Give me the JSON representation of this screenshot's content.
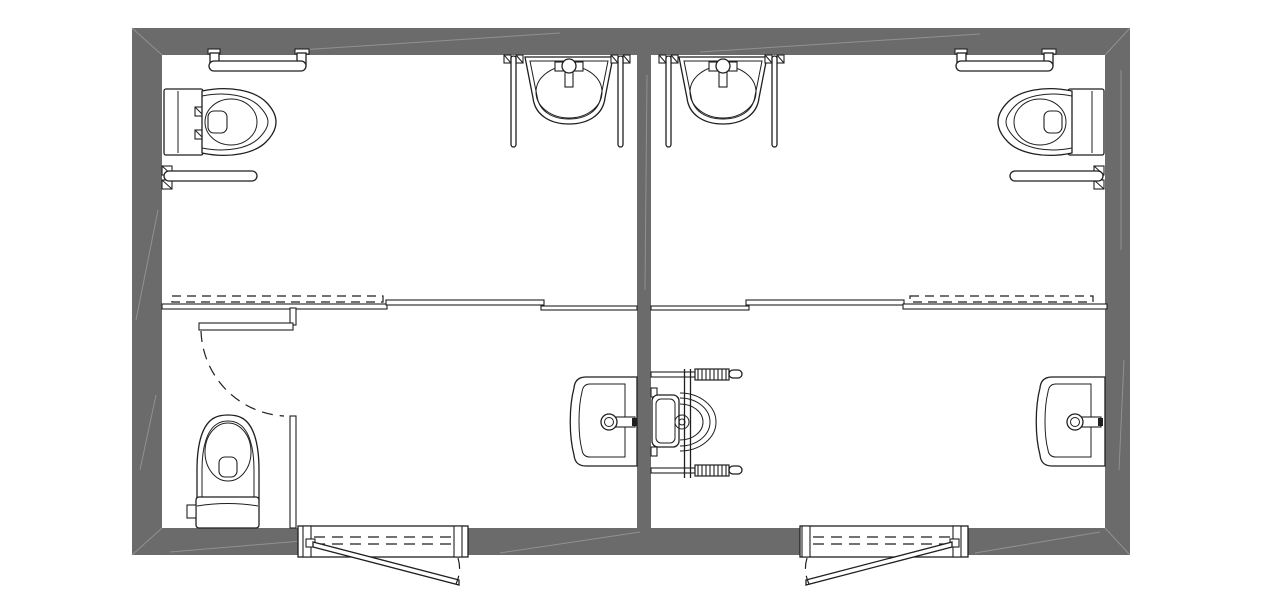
{
  "title": "Accessible public restroom floor plan - two mirrored WC units",
  "colors": {
    "wall": "#6b6b6b",
    "wall_highlight": "#9e9e9e",
    "line": "#1f1f1f",
    "background": "#ffffff",
    "fixture_fill": "#ffffff"
  },
  "plan": {
    "building_outline_px": {
      "left": 132,
      "top": 28,
      "right": 1130,
      "bottom": 555
    },
    "wall_thickness_px": {
      "top": 27,
      "bottom": 27,
      "left": 30,
      "right": 25
    },
    "center_dividing_wall_x_px": [
      637,
      651
    ],
    "units": [
      {
        "name": "left-restroom-unit",
        "fixtures": [
          {
            "type": "toilet",
            "position": "top-left, tank on left wall, bowl facing right",
            "bbox": [
              164,
              85,
              276,
              159
            ]
          },
          {
            "type": "grab-bar-u-shaped",
            "position": "top wall above toilet",
            "bbox": [
              207,
              49,
              309,
              71
            ]
          },
          {
            "type": "grab-bar-wall",
            "position": "left wall below toilet",
            "bbox": [
              162,
              166,
              257,
              190
            ]
          },
          {
            "type": "washbasin",
            "position": "top, left of center wall",
            "bbox": [
              525,
              57,
              613,
              124
            ]
          },
          {
            "type": "support-rail-vertical",
            "count": 2,
            "bbox": [
              509,
              54,
              625,
              147
            ]
          },
          {
            "type": "sliding-partition",
            "position": "mid-height partition with pocket door shown dashed",
            "bbox": [
              162,
              296,
              637,
              310
            ]
          },
          {
            "type": "wc-compartment",
            "position": "bottom-left with hinged door and swing arc",
            "bbox": [
              162,
              308,
              296,
              528
            ]
          },
          {
            "type": "toilet",
            "position": "bottom-left, tank on bottom wall, bowl facing up",
            "bbox": [
              187,
              414,
              260,
              529
            ]
          },
          {
            "type": "vanity-sink",
            "position": "bottom, mounted on center wall, faucet toward wall",
            "bbox": [
              570,
              376,
              637,
              467
            ]
          },
          {
            "type": "entrance-door-outswing",
            "position": "bottom wall, hinge left",
            "bbox": [
              298,
              526,
              468,
              586
            ]
          }
        ]
      },
      {
        "name": "right-restroom-unit",
        "fixtures": [
          {
            "type": "toilet",
            "position": "top-right, tank on right wall, bowl facing left",
            "bbox": [
              998,
              85,
              1104,
              159
            ]
          },
          {
            "type": "grab-bar-u-shaped",
            "position": "top wall above toilet",
            "bbox": [
              954,
              49,
              1058,
              71
            ]
          },
          {
            "type": "grab-bar-wall",
            "position": "right wall below toilet",
            "bbox": [
              1010,
              166,
              1104,
              190
            ]
          },
          {
            "type": "washbasin",
            "position": "top, right of center wall",
            "bbox": [
              679,
              57,
              767,
              124
            ]
          },
          {
            "type": "support-rail-vertical",
            "count": 2,
            "bbox": [
              659,
              54,
              779,
              147
            ]
          },
          {
            "type": "sliding-partition",
            "position": "mid-height partition with pocket door shown dashed",
            "bbox": [
              651,
              296,
              1107,
              310
            ]
          },
          {
            "type": "wheelchair-symbol",
            "position": "bottom center, turning space beside center wall",
            "bbox": [
              650,
              368,
              745,
              480
            ]
          },
          {
            "type": "vanity-sink",
            "position": "bottom, mounted on right wall, faucet toward wall",
            "bbox": [
              1038,
              376,
              1105,
              467
            ]
          },
          {
            "type": "entrance-door-outswing",
            "position": "bottom wall, hinge right",
            "bbox": [
              800,
              526,
              968,
              586
            ]
          }
        ]
      }
    ]
  }
}
